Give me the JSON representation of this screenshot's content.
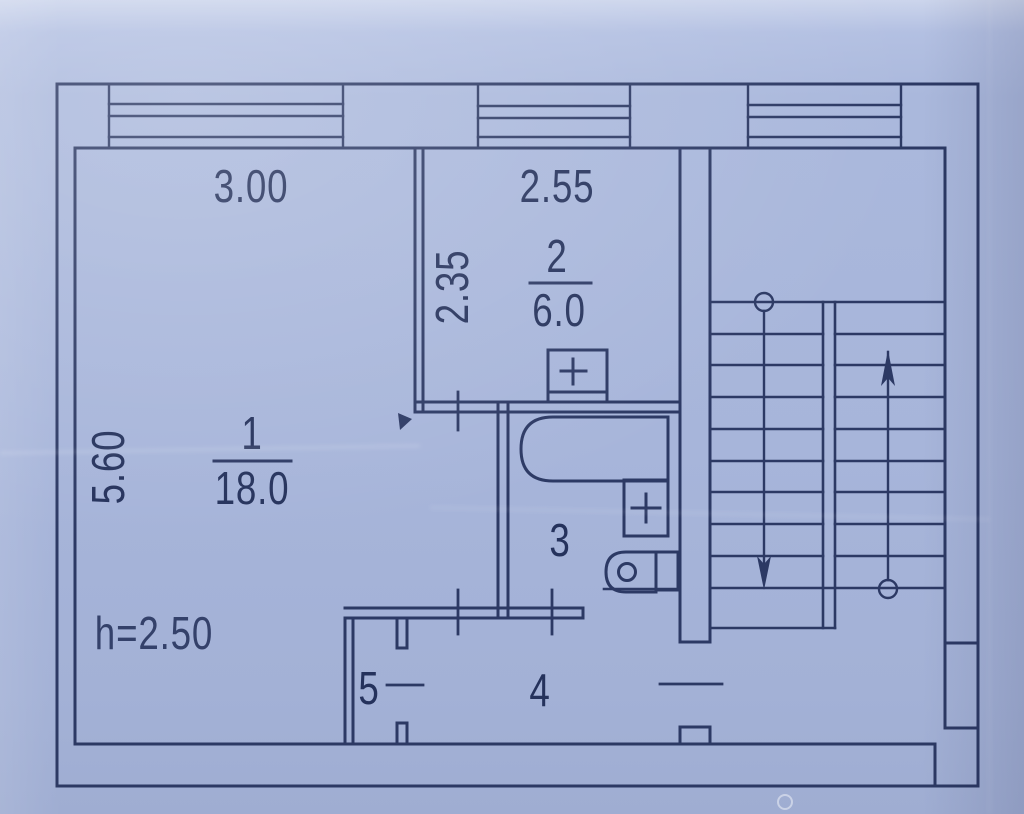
{
  "plan": {
    "title": "apartment-floor-plan",
    "dimensions": {
      "room1_width": "3.00",
      "room2_width": "2.55",
      "room2_depth": "2.35",
      "room1_depth": "5.60",
      "ceiling_height": "h=2.50"
    },
    "rooms": {
      "living": {
        "number": "1",
        "area": "18.0"
      },
      "kitchen": {
        "number": "2",
        "area": "6.0"
      },
      "bathroom": {
        "number": "3"
      },
      "hallway": {
        "number": "4"
      },
      "closet": {
        "number": "5"
      }
    },
    "colors": {
      "paper": "#a9b7db",
      "ink": "#25325c"
    }
  }
}
